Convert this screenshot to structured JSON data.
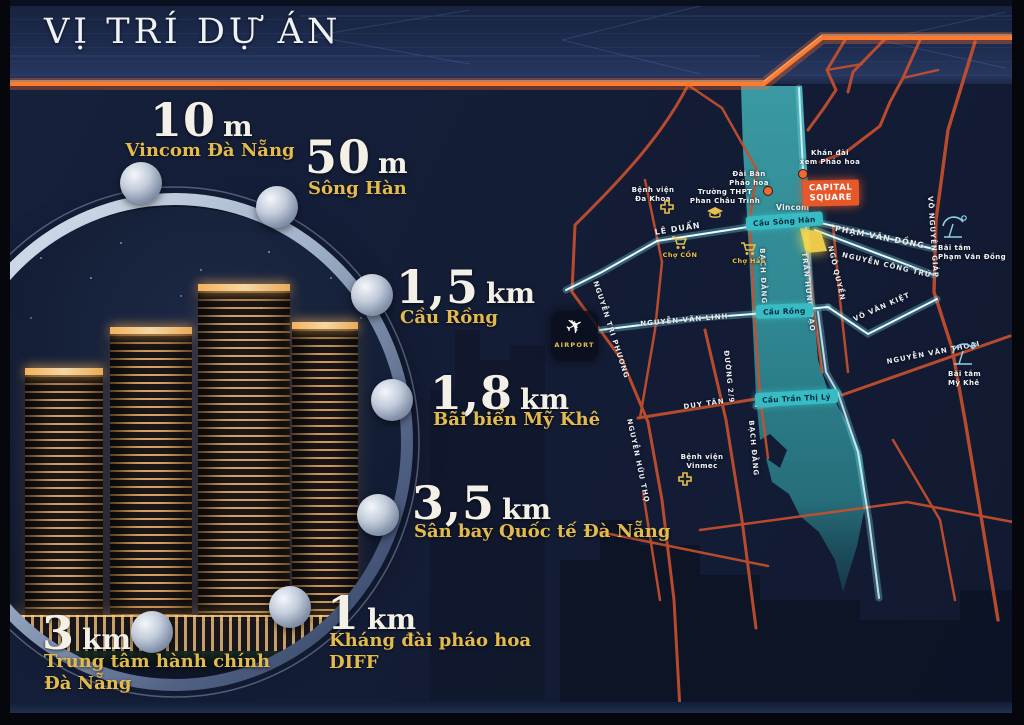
{
  "header": {
    "title": "VỊ TRÍ DỰ ÁN"
  },
  "distances": [
    {
      "value": "10",
      "unit": "m",
      "line1": "Vincom Đà Nẵng",
      "line2": ""
    },
    {
      "value": "50",
      "unit": "m",
      "line1": "Sông Hàn",
      "line2": ""
    },
    {
      "value": "1,5",
      "unit": "km",
      "line1": "Cầu Rồng",
      "line2": ""
    },
    {
      "value": "1,8",
      "unit": "km",
      "line1": "Bãi biển Mỹ Khê",
      "line2": ""
    },
    {
      "value": "3,5",
      "unit": "km",
      "line1": "Sân bay Quốc tế Đà Nẵng",
      "line2": ""
    },
    {
      "value": "1",
      "unit": "km",
      "line1": "Kháng đài pháo hoa",
      "line2": "DIFF"
    },
    {
      "value": "3",
      "unit": "km",
      "line1": "Trung tâm hành chính",
      "line2": "Đà Nẵng"
    }
  ],
  "map": {
    "project": {
      "line1": "CAPITAL",
      "line2": "SQUARE"
    },
    "airport": {
      "label": "AIRPORT"
    },
    "bridges": {
      "song_han": "Cầu Sông Hàn",
      "rong": "Cầu Rồng",
      "tran_thi_ly": "Cầu Trần Thị Lý"
    },
    "streets": {
      "le_duan": "LÊ DUẨN",
      "nguyen_van_linh": "NGUYỄN VĂN LINH",
      "duy_tan": "DUY TÂN",
      "pham_van_dong": "PHẠM VĂN ĐỒNG",
      "nguyen_cong_tru": "NGUYỄN CÔNG TRỨ",
      "vo_van_kiet": "VÕ VĂN KIỆT",
      "nguyen_van_thoai": "NGUYỄN VĂN THOẠI",
      "vo_nguyen_giap": "VÕ NGUYÊN GIÁP",
      "nguyen_tri_phuong": "NGUYỄN TRI PHƯƠNG",
      "nguyen_huu_tho": "NGUYỄN HỮU THỌ",
      "duong_2_9": "ĐƯỜNG 2/9",
      "bach_dang": "BẠCH ĐẰNG",
      "tran_hung_dao": "TRẦN HƯNG ĐẠO",
      "ngo_quyen": "NGÔ QUYỀN"
    },
    "landmarks": {
      "benh_vien_da_khoa": {
        "line1": "Bệnh viện",
        "line2": "Đa Khoa"
      },
      "truong_pct": {
        "line1": "Trường THPT",
        "line2": "Phan Châu Trinh"
      },
      "dai_ban": {
        "line1": "Đài Bắn",
        "line2": "Pháo hoa"
      },
      "khan_dai": {
        "line1": "Khán đài",
        "line2": "xem Pháo hoa"
      },
      "vincom": "Vincom",
      "cho_con": "Chợ CỒN",
      "cho_han": "Chợ Hàn",
      "benh_vien_vinmec": {
        "line1": "Bệnh viện",
        "line2": "Vinmec"
      },
      "bai_tam_pvd": {
        "line1": "Bãi tắm",
        "line2": "Phạm Văn Đồng"
      },
      "bai_tam_my_khe": {
        "line1": "Bãi tắm",
        "line2": "Mỹ Khê"
      }
    }
  },
  "icons": {
    "plane": "✈"
  },
  "colors": {
    "accent_orange": "#ff7a2e",
    "gold": "#e3ba4c",
    "river_teal": "#2e8a93",
    "road_orange": "#c7502d",
    "badge_teal": "#38bcc4",
    "capital_orange": "#e6582a",
    "glow_cyan": "#e6feff",
    "project_yellow": "#f6d44a"
  }
}
